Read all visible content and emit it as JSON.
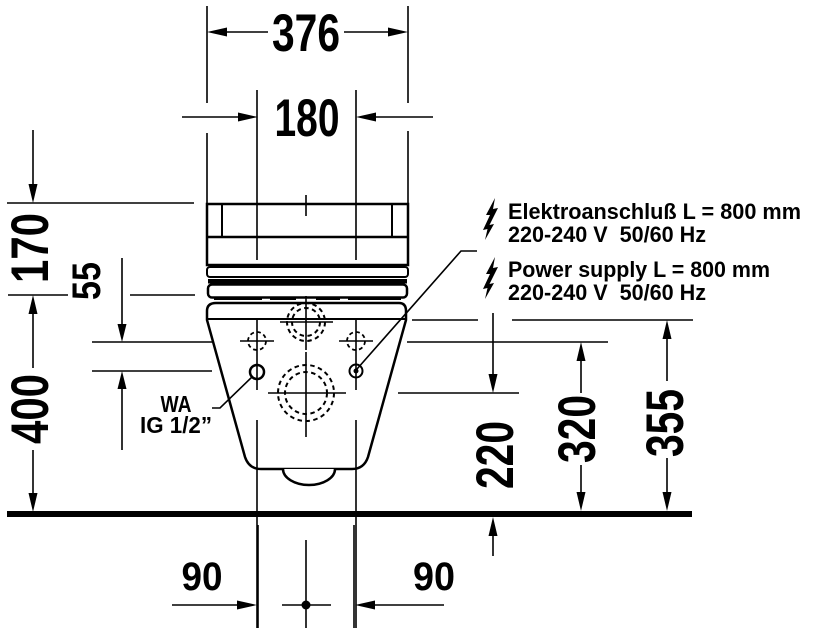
{
  "drawing_type": "technical-dimension-drawing",
  "dimensions": {
    "overall_width": "376",
    "hole_spacing": "180",
    "tank_height": "170",
    "connection_offset": "55",
    "total_height": "400",
    "outlet_height": "220",
    "fixing_height": "320",
    "connection_height": "355",
    "hole_offset_left": "90",
    "hole_offset_right": "90"
  },
  "annotations": {
    "electrical_de_line1": "Elektroanschluß L = 800 mm",
    "electrical_de_line2": "220-240 V  50/60 Hz",
    "electrical_en_line1": "Power supply L = 800 mm",
    "electrical_en_line2": "220-240 V  50/60 Hz",
    "water_label_line1": "WA",
    "water_label_line2": "IG 1/2”"
  },
  "colors": {
    "line": "#000000",
    "background": "#ffffff"
  }
}
